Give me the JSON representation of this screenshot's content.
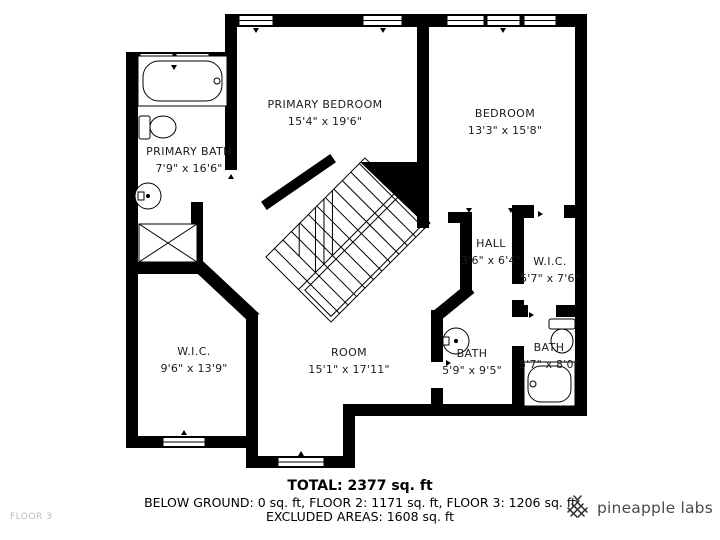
{
  "rooms": [
    {
      "name": "PRIMARY BEDROOM",
      "dims": "15'4\" x 19'6\""
    },
    {
      "name": "BEDROOM",
      "dims": "13'3\" x 15'8\""
    },
    {
      "name": "PRIMARY BATH",
      "dims": "7'9\" x 16'6\""
    },
    {
      "name": "HALL",
      "dims": "3'6\" x 6'4\""
    },
    {
      "name": "W.I.C.",
      "dims": "5'7\" x 7'6\""
    },
    {
      "name": "W.I.C.",
      "dims": "9'6\" x 13'9\""
    },
    {
      "name": "ROOM",
      "dims": "15'1\" x 17'11\""
    },
    {
      "name": "BATH",
      "dims": "5'9\" x 9'5\""
    },
    {
      "name": "BATH",
      "dims": "5'7\" x 8'0\""
    }
  ],
  "summary": {
    "total": "TOTAL: 2377 sq. ft",
    "floors": "BELOW GROUND: 0 sq. ft, FLOOR 2: 1171 sq. ft, FLOOR 3: 1206 sq. ft",
    "excluded": "EXCLUDED AREAS: 1608 sq. ft"
  },
  "footer": {
    "floor_label": "FLOOR 3",
    "brand": "pineapple labs"
  },
  "colors": {
    "wall": "#000000",
    "text": "#1b1b1b",
    "muted": "#bcbcbc",
    "brand": "#4a4a4a"
  }
}
